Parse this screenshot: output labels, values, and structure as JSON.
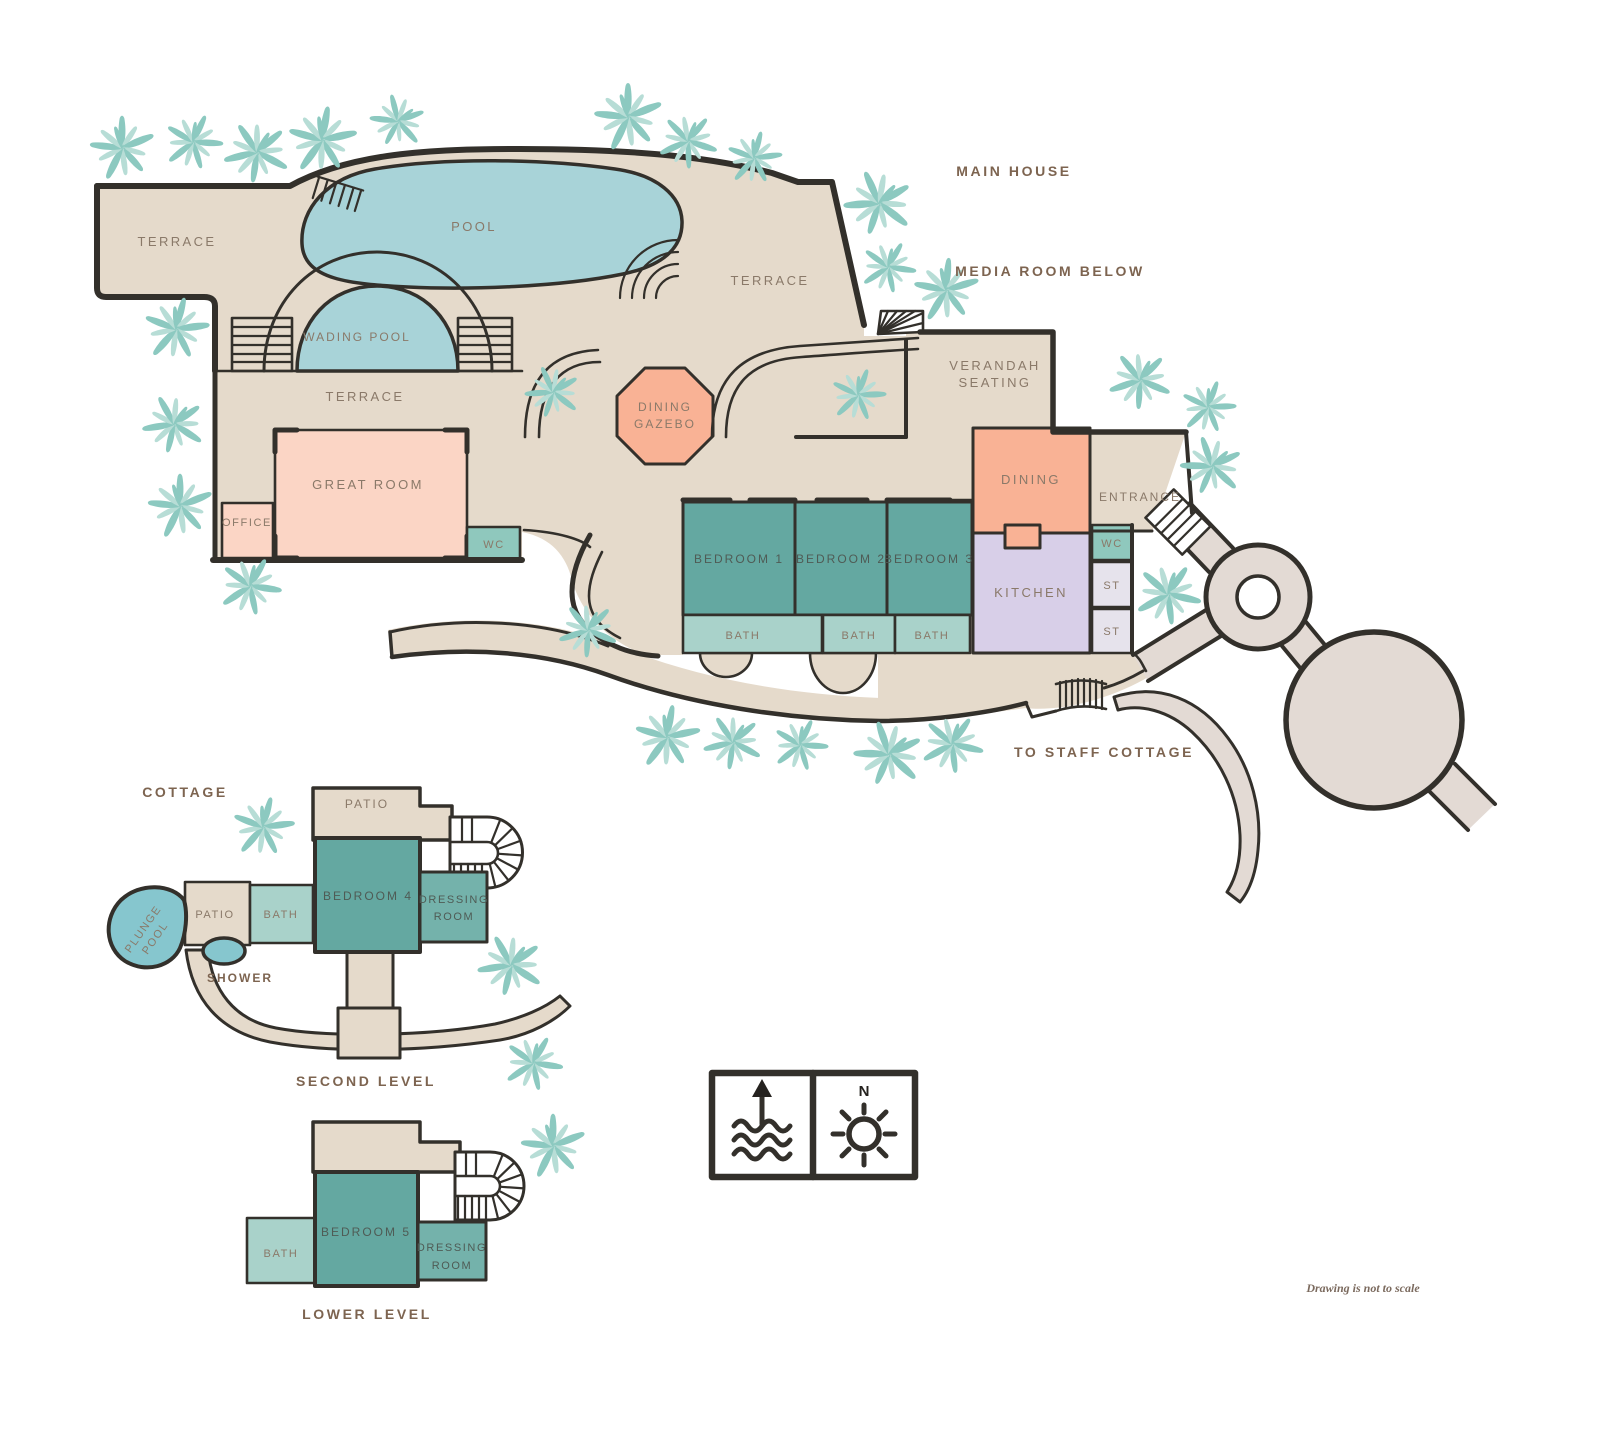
{
  "colors": {
    "floor_tan": "#E5DACB",
    "walkway": "#E3DAD4",
    "pool_blue": "#A8D3D8",
    "plunge_blue": "#86C6CE",
    "bedroom_teal": "#64A8A1",
    "dressing_teal": "#74B2AB",
    "bath_teal": "#A9D2CA",
    "wc_teal": "#8FC8BD",
    "peach": "#F9B295",
    "pink": "#FBD5C5",
    "lavender": "#D8CFE8",
    "storage_gray": "#E6E3EC",
    "outline": "#33302B",
    "tree_teal": "#8CC9C0",
    "tree_teal_light": "#B7DDD6"
  },
  "sections": {
    "main_house": "MAIN HOUSE",
    "media_room": "MEDIA ROOM BELOW",
    "to_staff_cottage": "TO STAFF COTTAGE",
    "cottage": "COTTAGE",
    "second_level": "SECOND LEVEL",
    "lower_level": "LOWER LEVEL"
  },
  "main": {
    "terrace_nw": "TERRACE",
    "pool": "POOL",
    "wading_pool": "WADING POOL",
    "terrace_mid": "TERRACE",
    "terrace_east": "TERRACE",
    "gazebo1": "DINING",
    "gazebo2": "GAZEBO",
    "great_room": "GREAT ROOM",
    "office": "OFFICE",
    "wc_west": "WC",
    "verandah1": "VERANDAH",
    "verandah2": "SEATING",
    "bedroom1": "BEDROOM 1",
    "bedroom2": "BEDROOM 2",
    "bedroom3": "BEDROOM 3",
    "bath1": "BATH",
    "bath2": "BATH",
    "bath3": "BATH",
    "dining": "DINING",
    "kitchen": "KITCHEN",
    "entrance": "ENTRANCE",
    "wc_east": "WC",
    "st1": "ST",
    "st2": "ST"
  },
  "cottage_upper": {
    "patio_top": "PATIO",
    "bedroom4": "BEDROOM 4",
    "dressing1": "DRESSING",
    "dressing2": "ROOM",
    "bath": "BATH",
    "patio": "PATIO",
    "plunge1": "PLUNGE",
    "plunge2": "POOL",
    "shower": "SHOWER"
  },
  "cottage_lower": {
    "bedroom5": "BEDROOM 5",
    "dressing1": "DRESSING",
    "dressing2": "ROOM",
    "bath": "BATH"
  },
  "legend": {
    "north": "N"
  },
  "note": {
    "scale": "Drawing is not to scale"
  }
}
